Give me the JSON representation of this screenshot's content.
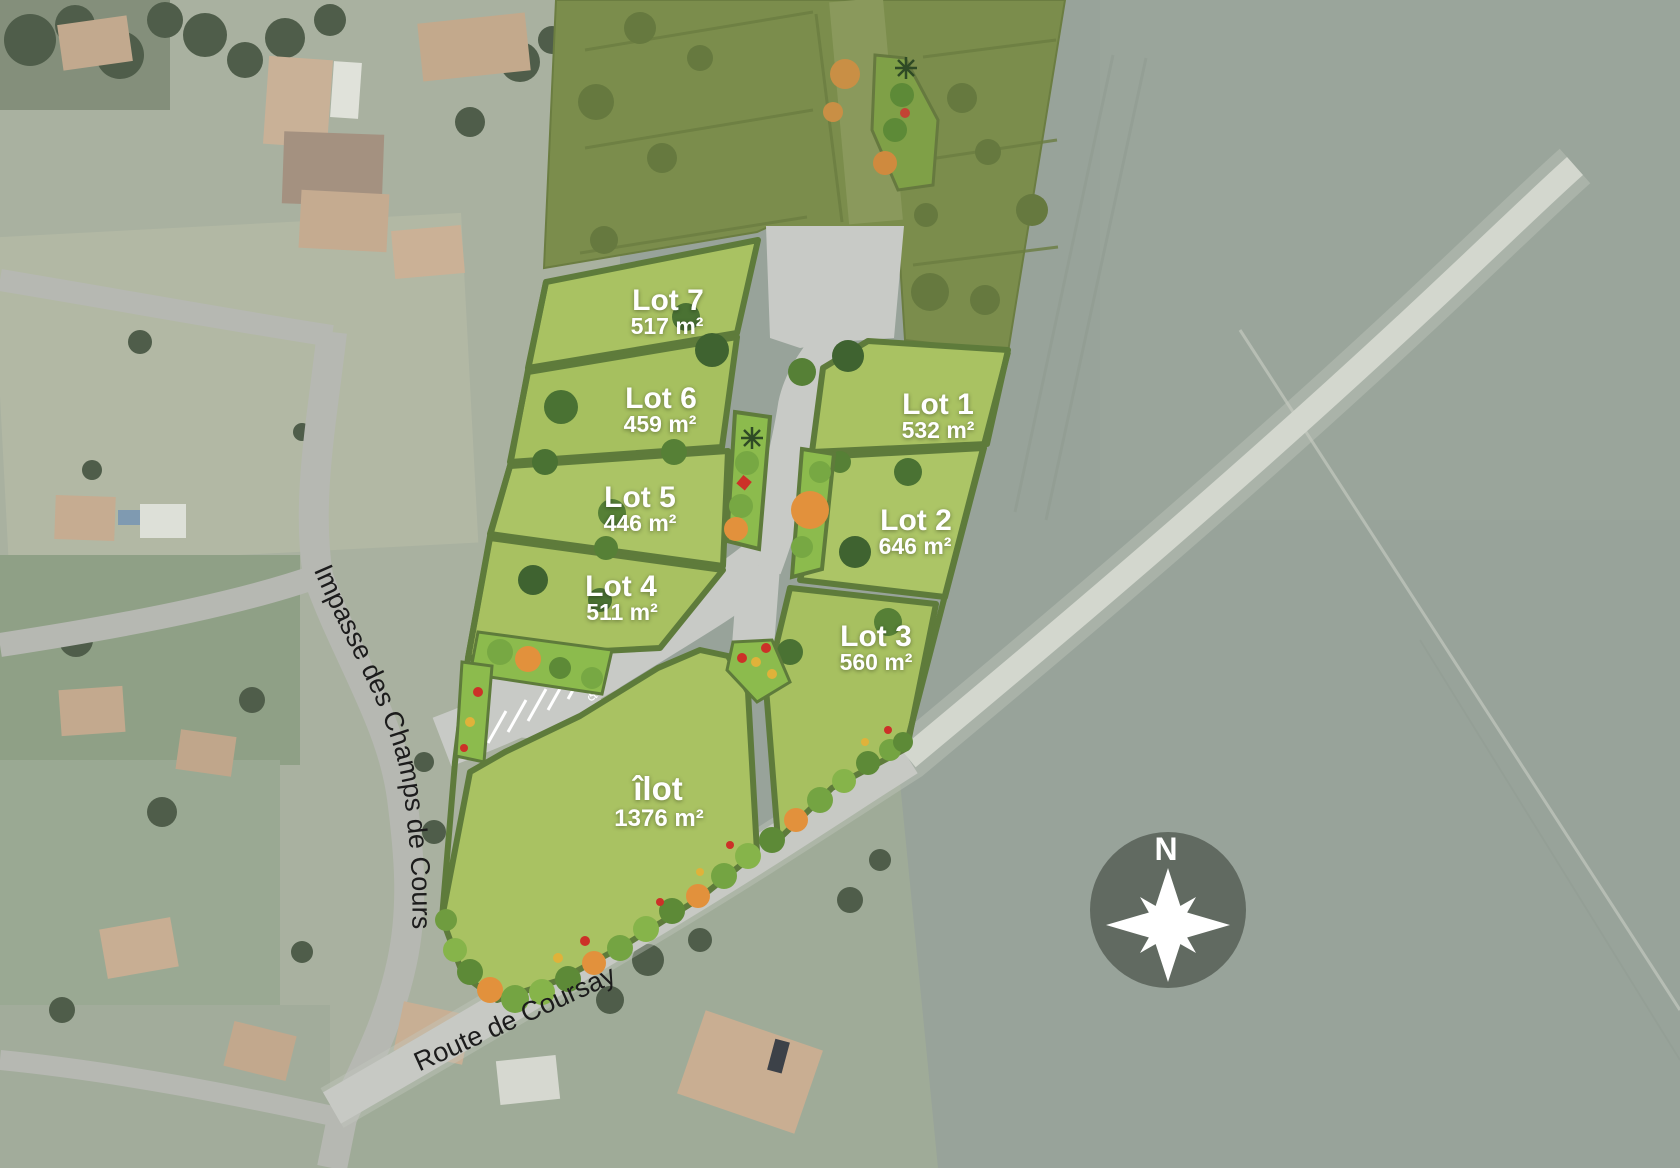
{
  "map": {
    "lots": [
      {
        "label": "Lot 1",
        "area": "532 m²"
      },
      {
        "label": "Lot 2",
        "area": "646 m²"
      },
      {
        "label": "Lot 3",
        "area": "560 m²"
      },
      {
        "label": "Lot 4",
        "area": "511 m²"
      },
      {
        "label": "Lot 5",
        "area": "446 m²"
      },
      {
        "label": "Lot 6",
        "area": "459 m²"
      },
      {
        "label": "Lot 7",
        "area": "517 m²"
      },
      {
        "label": "îlot",
        "area": "1376 m²"
      }
    ],
    "streets": [
      {
        "name": "Impasse des Champs de Cours"
      },
      {
        "name": "Route de Coursay"
      }
    ],
    "compass": {
      "label": "N"
    },
    "icons": {
      "accessible_parking": "♿"
    },
    "colors": {
      "lot_fill": "#a9c262",
      "hedge": "#5e7b3b",
      "phase_fill": "#7b8d4c",
      "road": "#c8cac6",
      "field": "#98a39a",
      "label_text": "#ffffff",
      "street_text": "#1c1c1c",
      "compass_bg": "#5c655c",
      "flower_orange": "#e2913c",
      "flower_red": "#cc3128"
    }
  }
}
